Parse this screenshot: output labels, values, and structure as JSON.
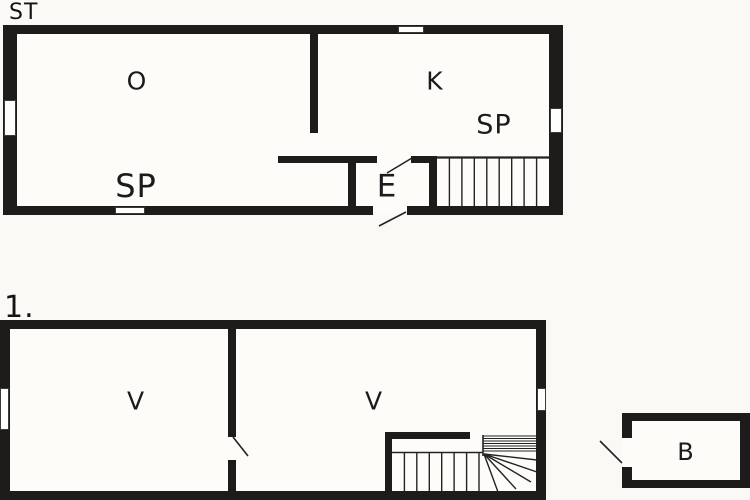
{
  "plan": {
    "background": "#faf9f6",
    "wall_color": "#1d1c1a",
    "line_color": "#232323",
    "text_color": "#1b1b1b",
    "floors": {
      "ground": {
        "title": "ST",
        "rooms": {
          "o": "O",
          "k": "K",
          "sp_upper": "SP",
          "sp_lower": "SP",
          "e": "E"
        }
      },
      "first": {
        "title": "1.",
        "rooms": {
          "v_left": "V",
          "v_right": "V"
        }
      },
      "annex": {
        "rooms": {
          "b": "B"
        }
      }
    }
  }
}
